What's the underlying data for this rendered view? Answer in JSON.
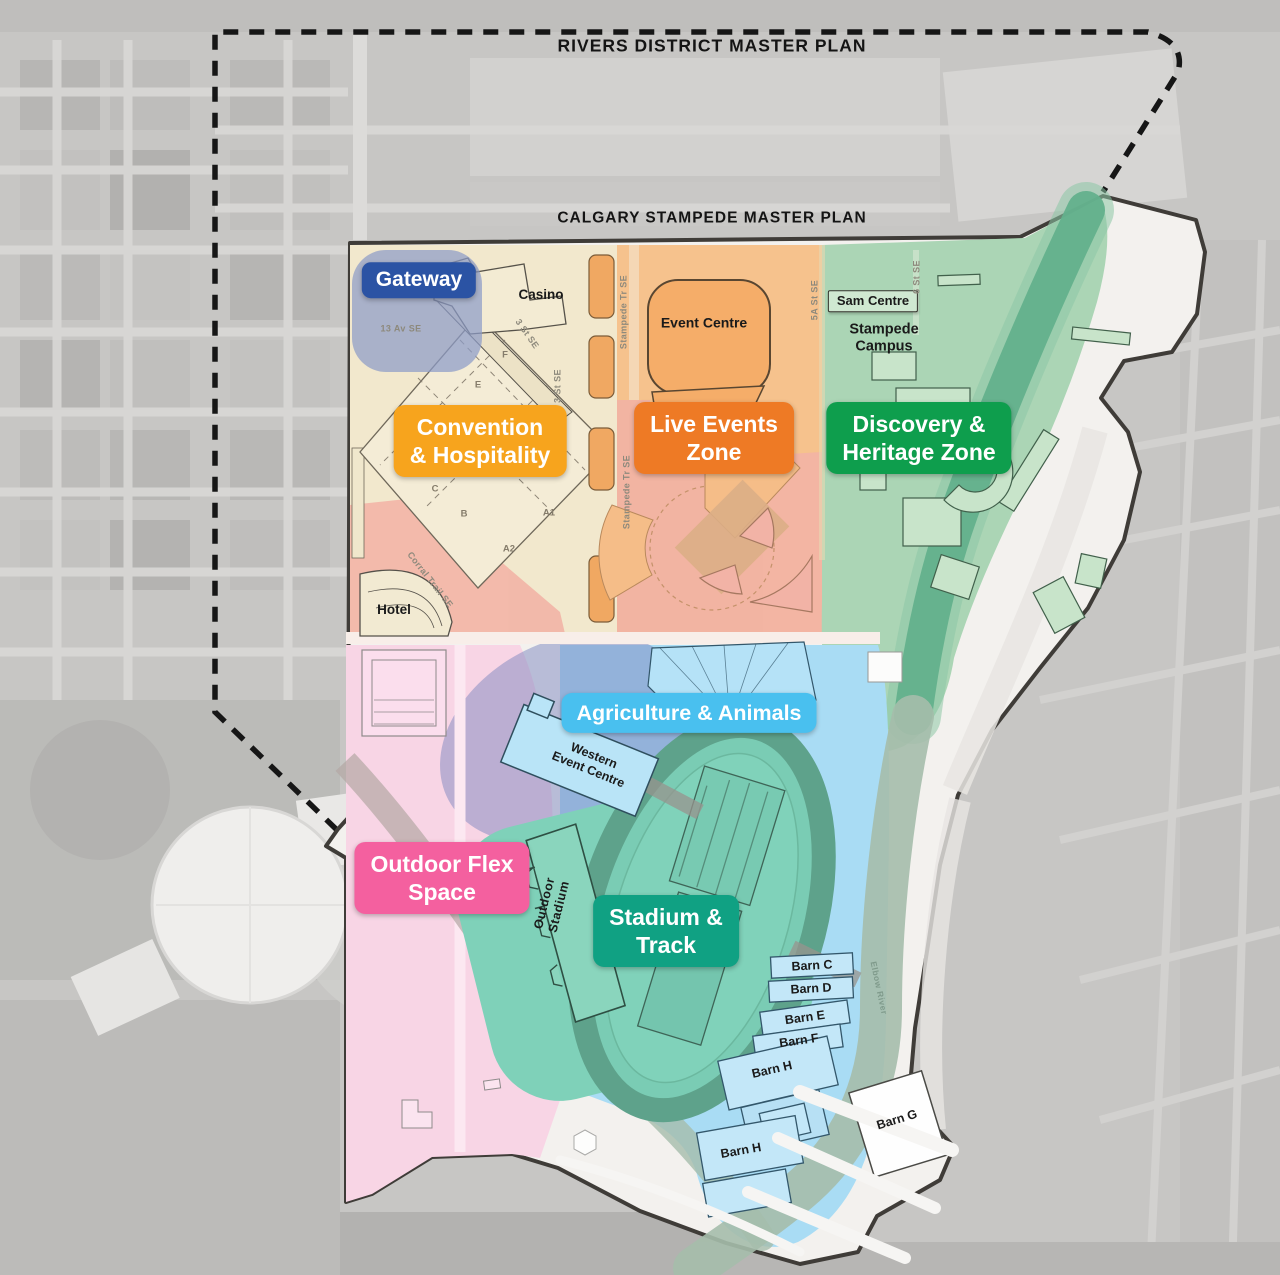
{
  "titles": {
    "rivers": "RIVERS DISTRICT MASTER PLAN",
    "calgary": "CALGARY STAMPEDE MASTER PLAN"
  },
  "badges": {
    "gateway": {
      "label": "Gateway",
      "color": "#2b53a4"
    },
    "convention": {
      "lines": [
        "Convention",
        "& Hospitality"
      ],
      "color": "#f7a41d"
    },
    "live_events": {
      "lines": [
        "Live Events",
        "Zone"
      ],
      "color": "#ee7a25"
    },
    "discovery": {
      "lines": [
        "Discovery &",
        "Heritage Zone"
      ],
      "color": "#0e9e4d"
    },
    "agriculture": {
      "label": "Agriculture & Animals",
      "color": "#49c0ef"
    },
    "outdoor_flex": {
      "lines": [
        "Outdoor Flex",
        "Space"
      ],
      "color": "#f4609f"
    },
    "stadium_track": {
      "lines": [
        "Stadium &",
        "Track"
      ],
      "color": "#10a183"
    }
  },
  "buildings": {
    "casino": "Casino",
    "event_centre": "Event Centre",
    "sam_centre": "Sam Centre",
    "stampede_campus": {
      "lines": [
        "Stampede",
        "Campus"
      ]
    },
    "hotel": "Hotel",
    "western_event_centre": {
      "lines": [
        "Western",
        "Event Centre"
      ]
    },
    "outdoor_stadium": {
      "lines": [
        "Outdoor",
        "Stadium"
      ]
    },
    "barns": {
      "c": "Barn C",
      "d": "Barn D",
      "e": "Barn E",
      "f": "Barn F",
      "h_upper": "Barn H",
      "h_lower": "Barn H",
      "g": "Barn G"
    }
  },
  "streets": {
    "av13": "13 Av SE",
    "st3": "3 St SE",
    "stampede_tr": "Stampede Tr SE",
    "st5a": "5A St SE",
    "st6": "6 St SE",
    "corral": "Corral Trail SE",
    "elbow_river": "Elbow River"
  },
  "parcel_letters": {
    "f": "F",
    "e": "E",
    "c": "C",
    "b": "B",
    "a1": "A1",
    "a2": "A2"
  },
  "zone_fill_colors": {
    "convention": "#f2e8cd",
    "live_events": "#f6c28d",
    "live_events_south": "#f2b3a6",
    "discovery": "#abd5b5",
    "river_in_park": "#63b08c",
    "river_south": "#a5bdab",
    "agriculture": "#a9dcf4",
    "outdoor_flex": "#f8d5e5",
    "stadium_track": "#7fd1b9",
    "gateway_halo": "#8c9bc8",
    "purple_overlay": "#7e88c0",
    "plan_interior": "#f3f1ee"
  }
}
